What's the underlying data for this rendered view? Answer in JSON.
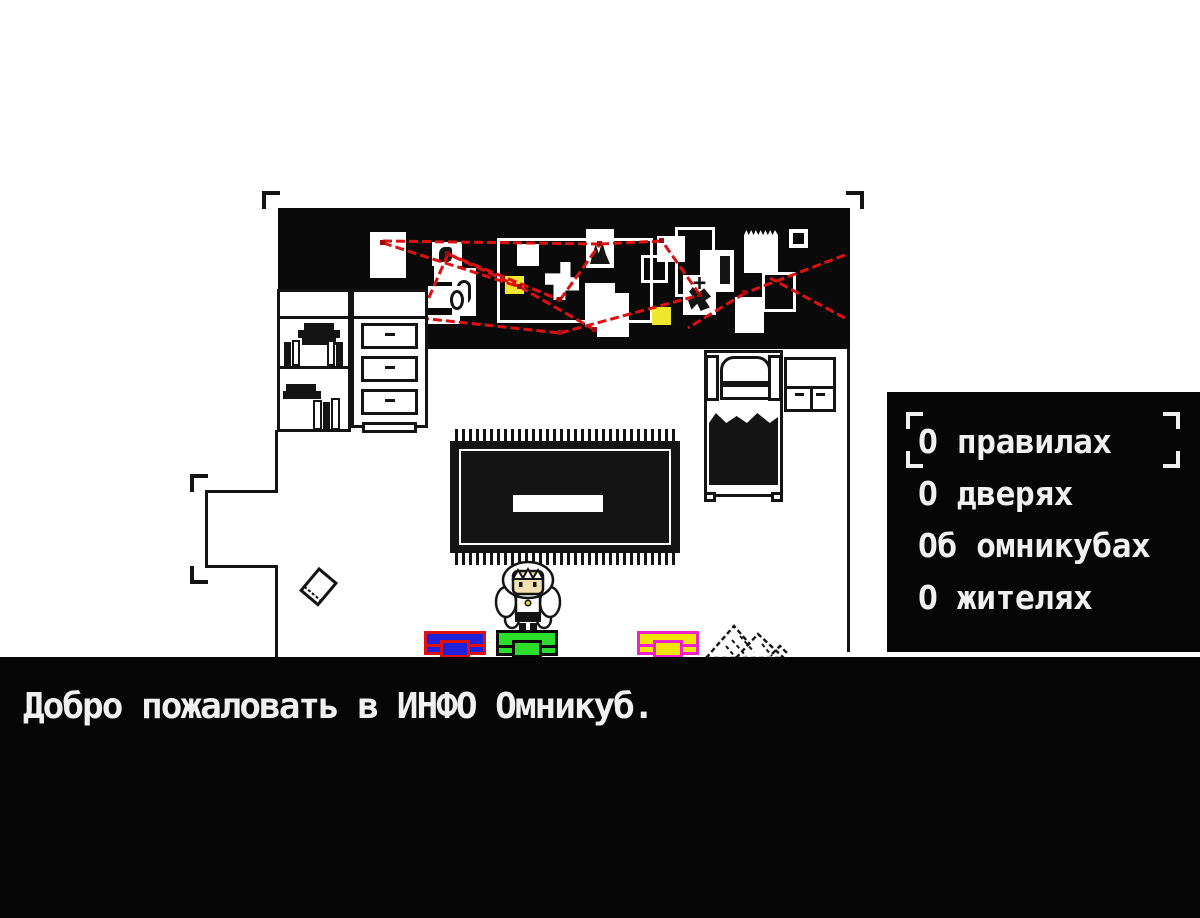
{
  "game": {
    "dialogue": {
      "text": "Добро пожаловать в ИНФО Омникуб."
    },
    "menu": {
      "selected_index": 0,
      "items": [
        {
          "label": "О правилах"
        },
        {
          "label": "О дверях"
        },
        {
          "label": "Об омникубах"
        },
        {
          "label": "О жителях"
        }
      ]
    },
    "room": {
      "objects": [
        "conspiracy-board",
        "bookshelf",
        "dresser",
        "bed",
        "nightstand",
        "rug",
        "floor-book",
        "player-character",
        "crate-blue",
        "crate-green",
        "crate-yellow",
        "paper-pile"
      ]
    }
  },
  "colors": {
    "background": "#ffffff",
    "wall": "#0a0a0a",
    "panel_bg": "#060606",
    "text": "#f0f0f0",
    "string_red": "#dd1111",
    "sticky_yellow": "#efe62e",
    "crate_blue": "#2222dd",
    "crate_blue_border": "#dd1111",
    "crate_green": "#2ade2a",
    "crate_green_border": "#0a0a0a",
    "crate_yellow": "#f2e40a",
    "crate_yellow_border": "#ee22cc",
    "skin": "#f2e2b0",
    "necklace_yellow": "#e8d40a"
  }
}
